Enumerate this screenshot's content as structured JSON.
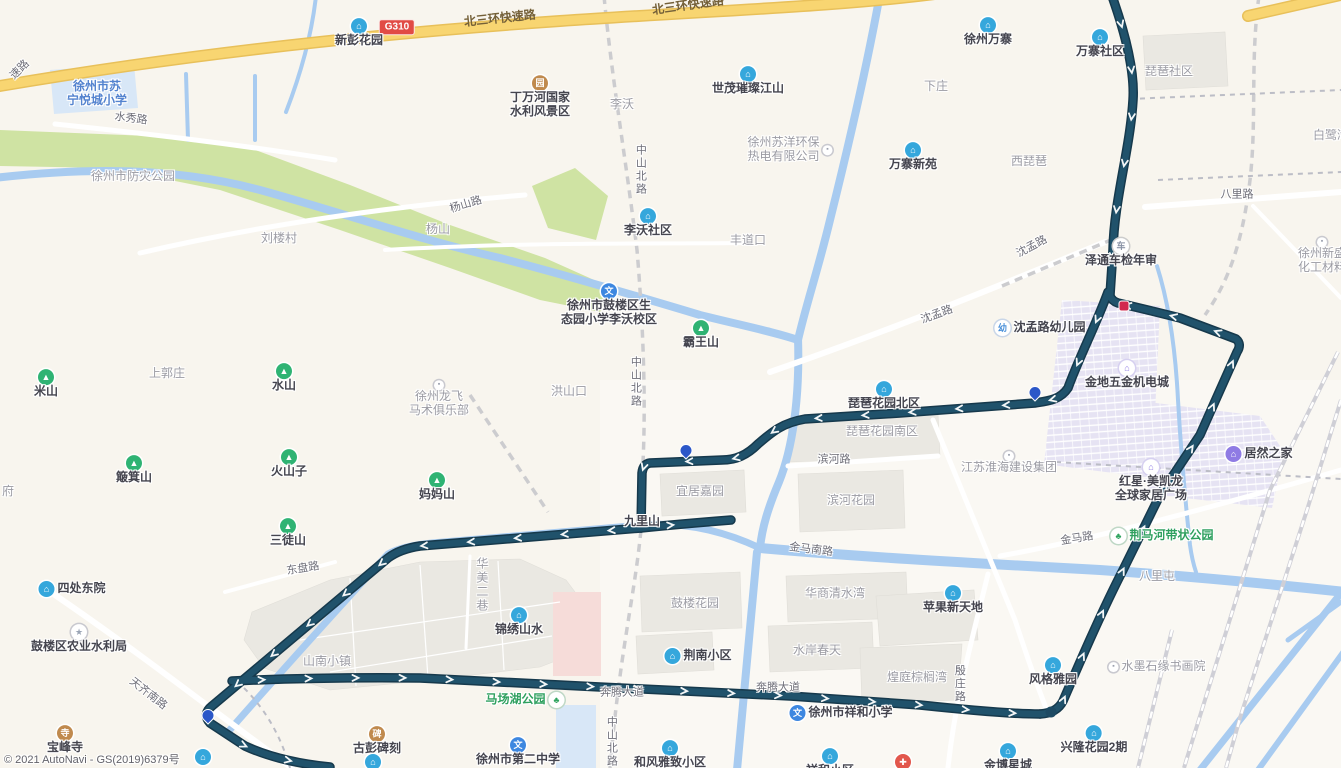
{
  "map": {
    "attribution": "© 2021 AutoNavi - GS(2019)6379号",
    "highway_badge": "G310",
    "colors": {
      "route": "#20526B",
      "route_casing": "#16394C",
      "water": "#A8CBF0",
      "highway": "#F8D571",
      "highway_casing": "#E8C05A",
      "park": "#CFE3A3",
      "building": "#EAE8E2",
      "commercial": "#E6E3F3",
      "pink_area": "#F6DCD9",
      "school_area": "#D8E7F7",
      "badge_red": "#E14B45",
      "poi_blue": "#35A7DC",
      "poi_green": "#2FB373",
      "poi_purple": "#8F7BE4",
      "poi_brown": "#C08A4E",
      "pin_blue": "#2B57C8",
      "marker_red": "#D2294E"
    },
    "labels": [
      {
        "t": "北三环快速路",
        "x": 500,
        "y": 19,
        "k": "hwy",
        "r": -6,
        "n": "road-label-beisanhuan-expressway"
      },
      {
        "t": "北三环快速路",
        "x": 688,
        "y": 6,
        "k": "hwy",
        "r": -8,
        "n": "road-label-beisanhuan-expressway"
      },
      {
        "t": "速路",
        "x": 20,
        "y": 70,
        "k": "road",
        "r": -45,
        "n": "road-label-expressway-partial"
      },
      {
        "t": "G310",
        "x": 397,
        "y": 27,
        "k": "badge",
        "n": "highway-badge-g310"
      },
      {
        "t": "水秀路",
        "x": 131,
        "y": 119,
        "k": "road",
        "r": 7,
        "n": "road-label-shuixiu"
      },
      {
        "t": "杨山路",
        "x": 466,
        "y": 205,
        "k": "road",
        "r": -17,
        "n": "road-label-yangshan"
      },
      {
        "t": "中山北路",
        "x": 640,
        "y": 170,
        "k": "road-vert",
        "n": "road-label-zhongshan-north"
      },
      {
        "t": "中山北路",
        "x": 635,
        "y": 382,
        "k": "road-vert",
        "n": "road-label-zhongshan-north"
      },
      {
        "t": "中山北路",
        "x": 611,
        "y": 742,
        "k": "road-vert",
        "n": "road-label-zhongshan-north"
      },
      {
        "t": "沈孟路",
        "x": 1032,
        "y": 247,
        "k": "road",
        "r": -28,
        "n": "road-label-shenmeng"
      },
      {
        "t": "沈孟路",
        "x": 937,
        "y": 315,
        "k": "road",
        "r": -20,
        "n": "road-label-shenmeng"
      },
      {
        "t": "滨河路",
        "x": 834,
        "y": 460,
        "k": "road",
        "n": "road-label-binhe"
      },
      {
        "t": "金马南路",
        "x": 811,
        "y": 550,
        "k": "road",
        "r": 7,
        "n": "road-label-jinma-south"
      },
      {
        "t": "金马路",
        "x": 1077,
        "y": 539,
        "k": "road",
        "r": -9,
        "n": "road-label-jinma"
      },
      {
        "t": "八里路",
        "x": 1237,
        "y": 195,
        "k": "road",
        "n": "road-label-bali"
      },
      {
        "t": "东盘路",
        "x": 303,
        "y": 569,
        "k": "road",
        "r": -9,
        "n": "road-label-dongpan"
      },
      {
        "t": "天齐南路",
        "x": 148,
        "y": 694,
        "k": "road",
        "r": 38,
        "n": "road-label-tianqi-south"
      },
      {
        "t": "奔腾大道",
        "x": 622,
        "y": 693,
        "k": "road",
        "n": "road-label-benteng-avenue"
      },
      {
        "t": "奔腾大道",
        "x": 778,
        "y": 688,
        "k": "road",
        "n": "road-label-benteng-avenue"
      },
      {
        "t": "殷庄路",
        "x": 959,
        "y": 684,
        "k": "road-vert",
        "n": "road-label-yinzhuang"
      },
      {
        "t": "李沃",
        "x": 622,
        "y": 105,
        "k": "area",
        "n": "area-label-liwo"
      },
      {
        "t": "下庄",
        "x": 936,
        "y": 87,
        "k": "area",
        "n": "area-label-xiazhuang"
      },
      {
        "t": "西琵琶",
        "x": 1029,
        "y": 162,
        "k": "area",
        "n": "area-label-xipipa"
      },
      {
        "t": "琵琶社区",
        "x": 1169,
        "y": 72,
        "k": "area",
        "n": "area-label-pipa-community"
      },
      {
        "t": "白鹭湾",
        "x": 1331,
        "y": 136,
        "k": "area",
        "n": "area-label-bailuwan"
      },
      {
        "t": "刘楼村",
        "x": 279,
        "y": 239,
        "k": "area",
        "n": "area-label-liulou-village"
      },
      {
        "t": "杨山",
        "x": 438,
        "y": 230,
        "k": "area",
        "n": "area-label-yangshan"
      },
      {
        "t": "上郭庄",
        "x": 167,
        "y": 374,
        "k": "area",
        "n": "area-label-shangguozhuang"
      },
      {
        "t": "洪山口",
        "x": 569,
        "y": 392,
        "k": "area",
        "n": "area-label-hongshankou"
      },
      {
        "t": "丰道口",
        "x": 748,
        "y": 241,
        "k": "area",
        "n": "area-label-fengdaokou"
      },
      {
        "t": "府",
        "x": 8,
        "y": 492,
        "k": "area",
        "n": "area-label-partial"
      },
      {
        "t": "九里山",
        "x": 642,
        "y": 522,
        "k": "poi-plain",
        "n": "area-label-jiulishan"
      },
      {
        "t": "八里屯",
        "x": 1157,
        "y": 577,
        "k": "area",
        "n": "area-label-balitun"
      },
      {
        "t": "山南小镇",
        "x": 327,
        "y": 662,
        "k": "area",
        "n": "area-label-shannan-town"
      },
      {
        "t": "华美二巷",
        "x": 481,
        "y": 585,
        "k": "area-vert",
        "n": "area-label-huamei-lane"
      },
      {
        "t": "宜居嘉园",
        "x": 700,
        "y": 492,
        "k": "area",
        "n": "area-label-yiju-garden"
      },
      {
        "t": "琵琶花园南区",
        "x": 882,
        "y": 432,
        "k": "area",
        "n": "area-label-pipa-garden-south"
      },
      {
        "t": "滨河花园",
        "x": 851,
        "y": 501,
        "k": "area",
        "n": "area-label-binhe-garden"
      },
      {
        "t": "华商清水湾",
        "x": 835,
        "y": 594,
        "k": "area",
        "n": "area-label-huashang-qingshuiwan"
      },
      {
        "t": "水岸春天",
        "x": 817,
        "y": 651,
        "k": "area",
        "n": "area-label-shuian-chuntian"
      },
      {
        "t": "鼓楼花园",
        "x": 695,
        "y": 604,
        "k": "area",
        "n": "area-label-gulou-garden"
      },
      {
        "t": "煌庭棕榈湾",
        "x": 917,
        "y": 678,
        "k": "area",
        "n": "area-label-huangting-zonglvwan"
      },
      {
        "t": "徐州市防灾公园",
        "x": 133,
        "y": 177,
        "k": "area",
        "n": "area-label-fangzai-park"
      },
      {
        "t": "新彭花园",
        "x": 359,
        "y": 33,
        "k": "poi",
        "i": "building-blue",
        "n": "poi-xinpeng-garden"
      },
      {
        "t": "徐州万寨",
        "x": 988,
        "y": 32,
        "k": "poi",
        "i": "building-blue",
        "n": "poi-xuzhou-wanzhai"
      },
      {
        "t": "万寨社区",
        "x": 1100,
        "y": 44,
        "k": "poi",
        "i": "building-blue",
        "n": "poi-wanzhai-community"
      },
      {
        "t": "万寨新苑",
        "x": 913,
        "y": 157,
        "k": "poi",
        "i": "building-blue",
        "n": "poi-wanzhai-xinyuan"
      },
      {
        "t": "世茂璀璨江山",
        "x": 748,
        "y": 81,
        "k": "poi",
        "i": "building-blue",
        "n": "poi-shimao"
      },
      {
        "t": "李沃社区",
        "x": 648,
        "y": 223,
        "k": "poi",
        "i": "building-blue",
        "n": "poi-liwo-community"
      },
      {
        "lines": [
          "丁万河国家",
          "水利风景区"
        ],
        "x": 540,
        "y": 97,
        "k": "poi",
        "i": "scenic-brown",
        "n": "poi-dingwanhe-scenic-area"
      },
      {
        "lines": [
          "徐州市苏",
          "宁悦城小学"
        ],
        "x": 97,
        "y": 94,
        "k": "school-txt",
        "n": "poi-suning-yuecheng-school"
      },
      {
        "lines": [
          "徐州苏洋环保",
          "热电有限公司"
        ],
        "x": 790,
        "y": 150,
        "k": "area",
        "i": "dot-white",
        "ip": "right",
        "n": "poi-suyang-thermal-power"
      },
      {
        "t": "泽通车检年审",
        "x": 1121,
        "y": 253,
        "k": "poi",
        "i": "car-white",
        "n": "poi-zetong-vehicle-inspection"
      },
      {
        "t": "沈孟路幼儿园",
        "x": 1040,
        "y": 328,
        "k": "poi",
        "i": "kindergarten-white",
        "ip": "left",
        "n": "poi-shenmeng-kindergarten"
      },
      {
        "t": "金地五金机电城",
        "x": 1127,
        "y": 375,
        "k": "poi",
        "i": "shop-purple-light",
        "n": "poi-jindi-hardware-city"
      },
      {
        "lines": [
          "红星·美凯龙",
          "全球家居广场"
        ],
        "x": 1151,
        "y": 481,
        "k": "poi",
        "i": "shop-purple-light",
        "n": "poi-hongxing-meikailong"
      },
      {
        "t": "居然之家",
        "x": 1259,
        "y": 454,
        "k": "poi",
        "i": "shop-purple",
        "ip": "left",
        "n": "poi-juran-home"
      },
      {
        "t": "江苏淮海建设集团",
        "x": 1009,
        "y": 463,
        "k": "area",
        "i": "dot-white",
        "n": "poi-huaihai-construction-group"
      },
      {
        "t": "琵琶花园北区",
        "x": 884,
        "y": 396,
        "k": "poi",
        "i": "building-blue",
        "n": "poi-pipa-garden-north"
      },
      {
        "t": "苹果新天地",
        "x": 953,
        "y": 600,
        "k": "poi",
        "i": "building-blue",
        "n": "poi-pingguo-xintiandi"
      },
      {
        "t": "风格雅园",
        "x": 1053,
        "y": 672,
        "k": "poi",
        "i": "building-blue",
        "n": "poi-fengge-yayuan"
      },
      {
        "t": "兴隆花园2期",
        "x": 1094,
        "y": 740,
        "k": "poi",
        "i": "building-blue",
        "n": "poi-xinglong-garden-2"
      },
      {
        "t": "金博星城",
        "x": 1008,
        "y": 758,
        "k": "poi",
        "i": "building-blue",
        "n": "poi-jinbo-xingcheng"
      },
      {
        "t": "水墨石缘书画院",
        "x": 1157,
        "y": 667,
        "k": "area",
        "i": "dot-white",
        "ip": "left",
        "n": "poi-shuimo-art-academy"
      },
      {
        "t": "荆马河带状公园",
        "x": 1162,
        "y": 536,
        "k": "green-txt",
        "i": "park-green",
        "ip": "left",
        "n": "poi-jingmahe-park"
      },
      {
        "t": "马场湖公园",
        "x": 525,
        "y": 700,
        "k": "green-txt",
        "i": "park-green",
        "ip": "right",
        "n": "poi-machanghu-park"
      },
      {
        "t": "四处东院",
        "x": 72,
        "y": 589,
        "k": "poi",
        "i": "building-blue",
        "ip": "left",
        "n": "poi-sichu-dongyuan"
      },
      {
        "t": "鼓楼区农业水利局",
        "x": 79,
        "y": 639,
        "k": "poi",
        "i": "star-gray",
        "n": "poi-gulou-water-bureau"
      },
      {
        "t": "古彭碑刻",
        "x": 377,
        "y": 741,
        "k": "poi",
        "i": "carve-brown",
        "n": "poi-gupeng-steles"
      },
      {
        "t": "宝峰寺",
        "x": 65,
        "y": 740,
        "k": "poi",
        "i": "temple-brown",
        "n": "poi-baofeng-temple"
      },
      {
        "t": "徐州市第二中学",
        "x": 518,
        "y": 752,
        "k": "poi",
        "i": "school-blue",
        "n": "poi-no2-middle-school"
      },
      {
        "t": "徐州市祥和小学",
        "x": 841,
        "y": 713,
        "k": "poi",
        "i": "school-blue",
        "ip": "left",
        "n": "poi-xianghe-primary-school"
      },
      {
        "lines": [
          "徐州市鼓楼区生",
          "态园小学李沃校区"
        ],
        "x": 609,
        "y": 305,
        "k": "poi",
        "i": "school-blue",
        "n": "poi-shengtaiyuan-school-liwo"
      },
      {
        "t": "霸王山",
        "x": 701,
        "y": 335,
        "k": "poi",
        "i": "mountain-green",
        "n": "poi-bawangshan"
      },
      {
        "t": "米山",
        "x": 46,
        "y": 384,
        "k": "poi",
        "i": "mountain-green",
        "n": "poi-mishan"
      },
      {
        "t": "水山",
        "x": 284,
        "y": 378,
        "k": "poi",
        "i": "mountain-green",
        "n": "poi-shuishan"
      },
      {
        "t": "簸箕山",
        "x": 134,
        "y": 470,
        "k": "poi",
        "i": "mountain-green",
        "n": "poi-bojishan"
      },
      {
        "t": "火山子",
        "x": 289,
        "y": 464,
        "k": "poi",
        "i": "mountain-green",
        "n": "poi-huoshanzi"
      },
      {
        "t": "三徒山",
        "x": 288,
        "y": 533,
        "k": "poi",
        "i": "mountain-green",
        "n": "poi-santushan"
      },
      {
        "t": "妈妈山",
        "x": 437,
        "y": 487,
        "k": "poi",
        "i": "mountain-green",
        "n": "poi-mamashan"
      },
      {
        "lines": [
          "徐州龙飞",
          "马术俱乐部"
        ],
        "x": 439,
        "y": 399,
        "k": "area",
        "i": "dot-white",
        "n": "poi-longfei-equestrian-club"
      },
      {
        "t": "锦绣山水",
        "x": 519,
        "y": 622,
        "k": "poi",
        "i": "building-blue",
        "n": "poi-jinxiu-shanshui"
      },
      {
        "t": "荆南小区",
        "x": 698,
        "y": 656,
        "k": "poi",
        "i": "building-blue",
        "ip": "left",
        "n": "poi-jingnan-community"
      },
      {
        "t": "和风雅致小区",
        "x": 670,
        "y": 755,
        "k": "poi",
        "i": "building-blue",
        "n": "poi-hefeng-yazhi"
      },
      {
        "t": "祥和小区",
        "x": 830,
        "y": 763,
        "k": "poi",
        "i": "building-blue",
        "n": "poi-xianghe-community"
      },
      {
        "lines": [
          "徐州新盛",
          "化工材料"
        ],
        "x": 1322,
        "y": 256,
        "k": "area",
        "i": "dot-white",
        "n": "poi-xinsheng-chemical"
      },
      {
        "x": 203,
        "y": 757,
        "k": "icon-only",
        "i": "building-blue",
        "n": "poi-icon-clipped"
      },
      {
        "x": 373,
        "y": 762,
        "k": "icon-only",
        "i": "building-blue",
        "n": "poi-icon-clipped"
      },
      {
        "x": 903,
        "y": 762,
        "k": "icon-only",
        "i": "hospital-red",
        "n": "poi-hospital-clipped"
      }
    ],
    "markers": [
      {
        "type": "pin-blue",
        "x": 1035,
        "y": 399,
        "n": "bus-stop-pin"
      },
      {
        "type": "pin-blue",
        "x": 686,
        "y": 457,
        "n": "bus-stop-pin"
      },
      {
        "type": "pin-blue",
        "x": 208,
        "y": 722,
        "n": "bus-stop-pin"
      },
      {
        "type": "dot-red",
        "x": 1124,
        "y": 306,
        "n": "selected-stop-marker"
      },
      {
        "type": "dot-navy",
        "x": 1051,
        "y": 712,
        "n": "route-corner-node"
      }
    ]
  }
}
